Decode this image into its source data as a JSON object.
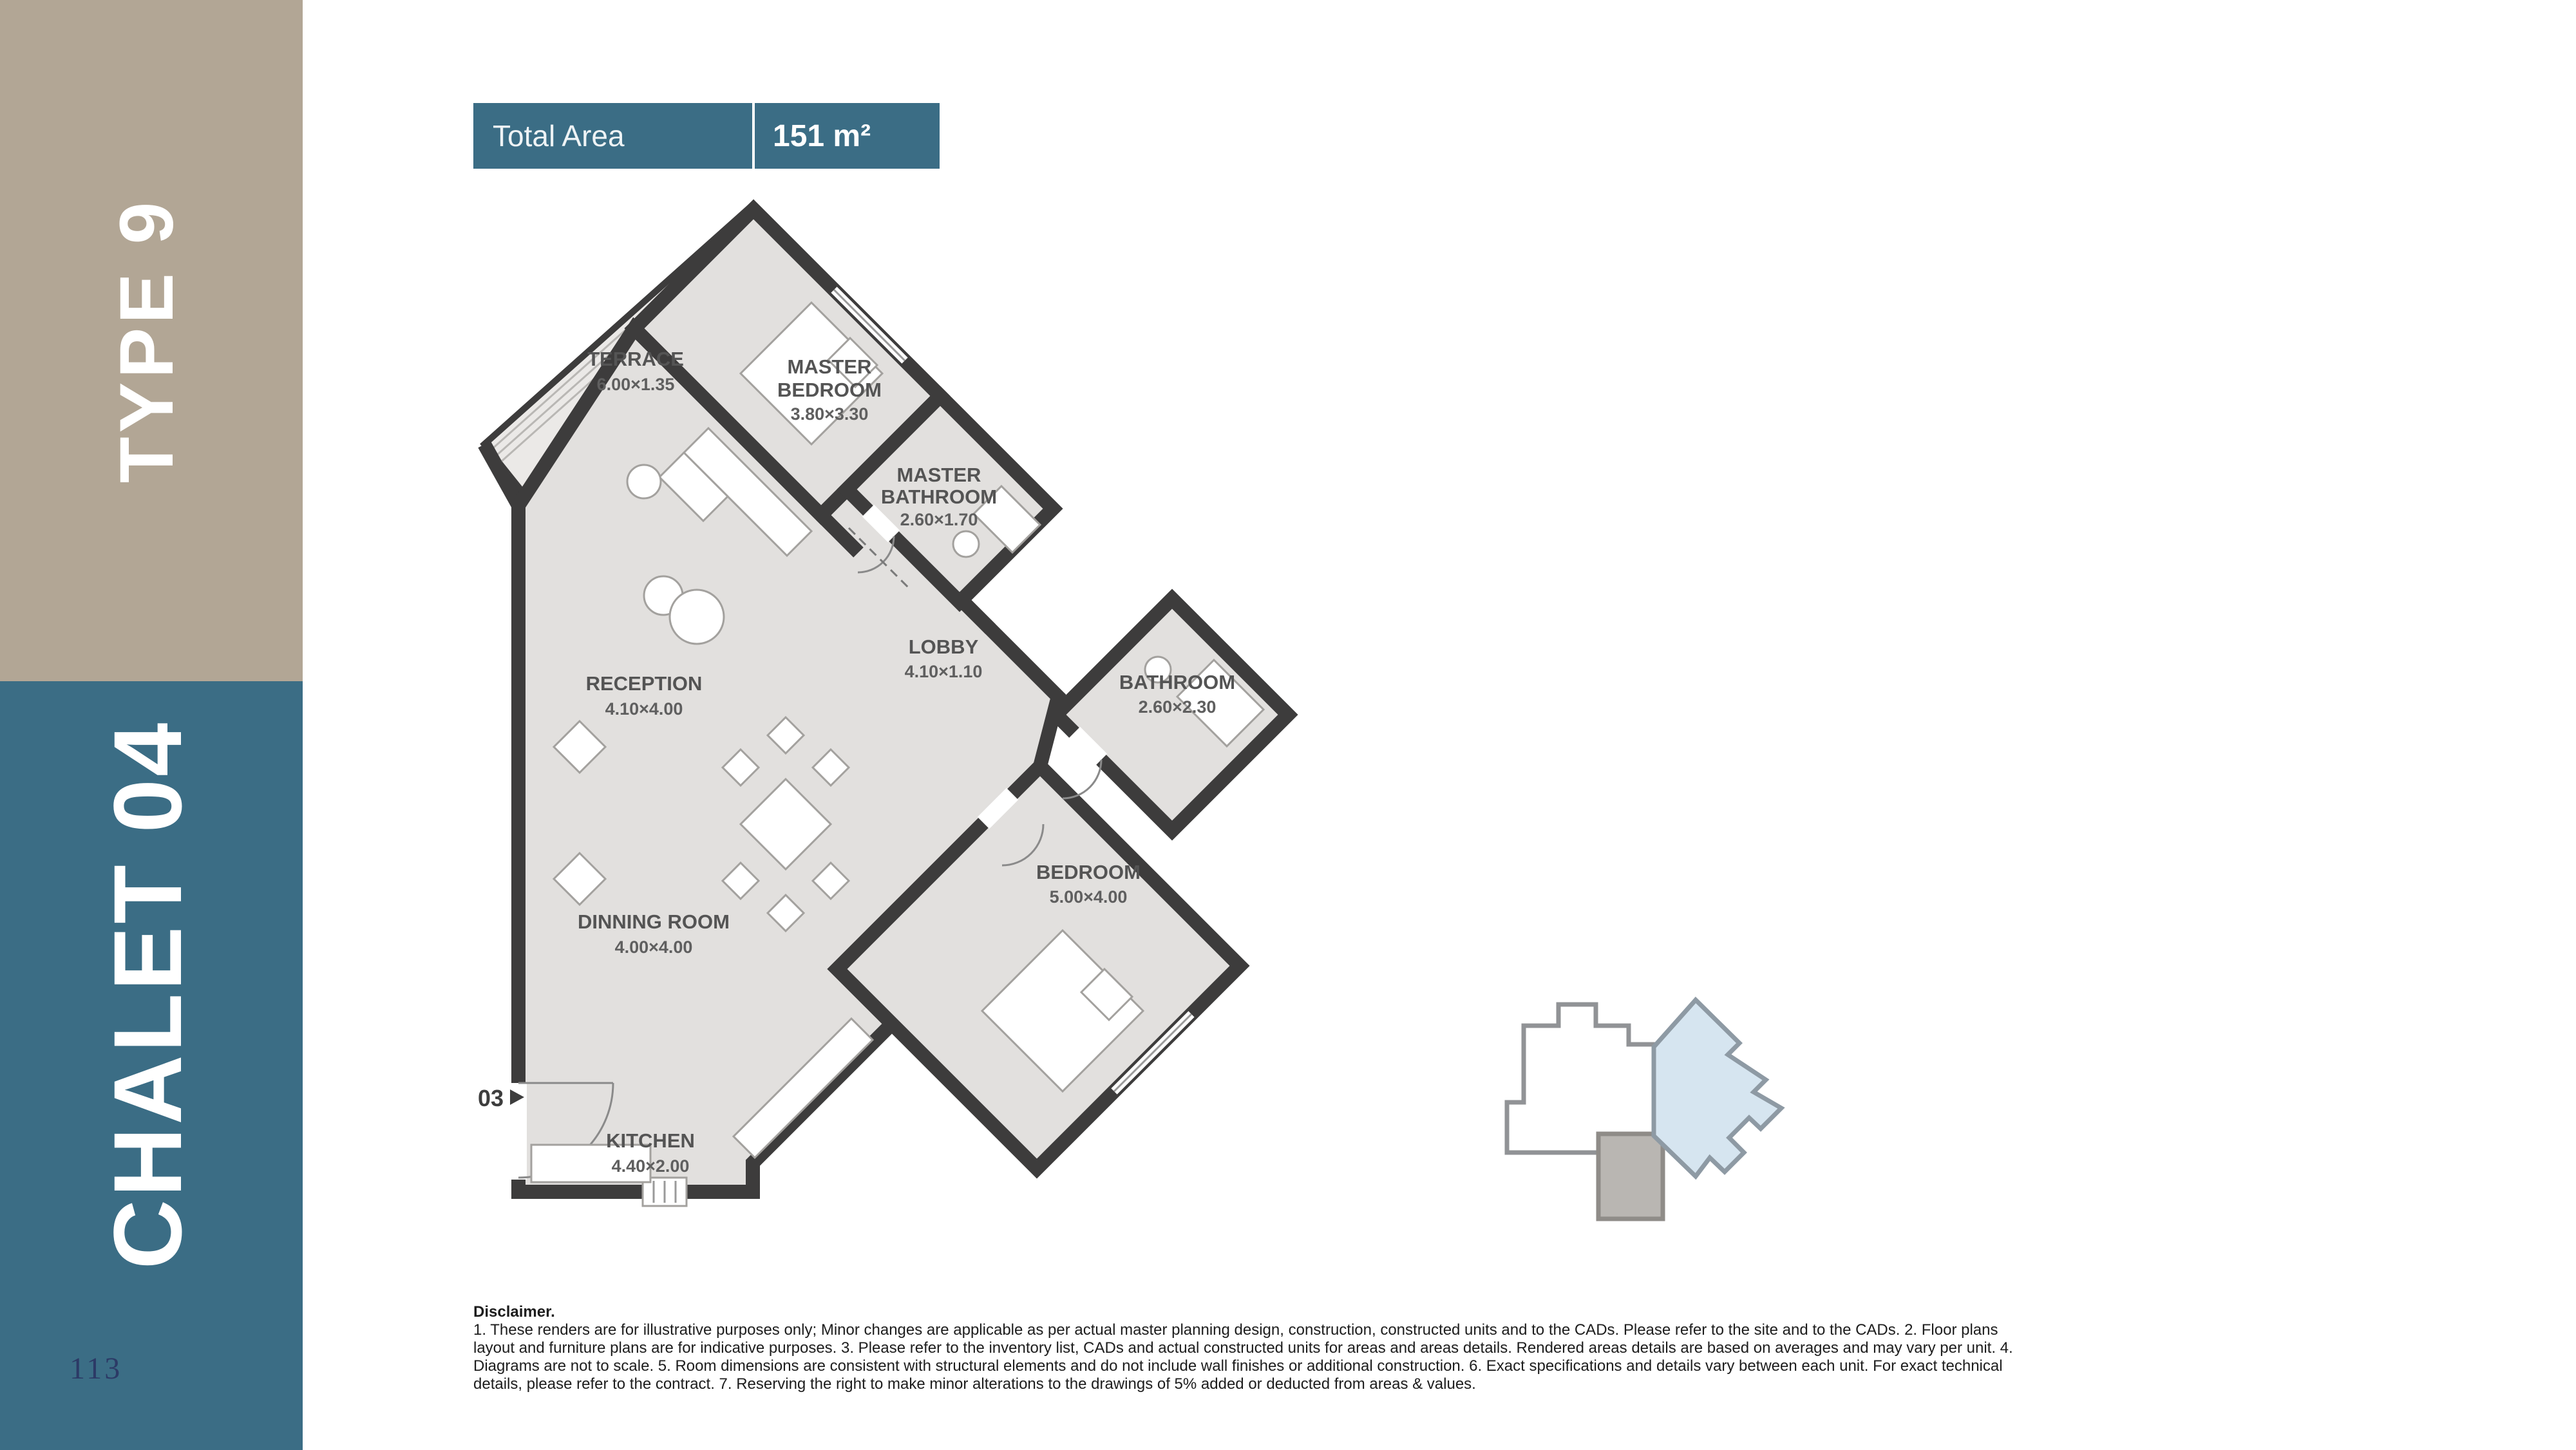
{
  "theme": {
    "tan": "#b2a695",
    "teal": "#3b6d85",
    "page_num_navy": "#2c3a66",
    "wall": "#3d3c3c",
    "floor": "#e2e0de",
    "locator_blue": "#d6e5f0",
    "locator_gray": "#b9b6b2"
  },
  "sidebar": {
    "type_label": "TYPE 9",
    "chalet_label": "CHALET 04",
    "page_number": "113"
  },
  "header": {
    "total_area_label": "Total Area",
    "total_area_value": "151 m²"
  },
  "floor_plan": {
    "entrance_label": "03",
    "rooms": [
      {
        "line1": "TERRACE",
        "line2": "",
        "dims": "6.00×1.35"
      },
      {
        "line1": "MASTER",
        "line2": "BEDROOM",
        "dims": "3.80×3.30"
      },
      {
        "line1": "MASTER",
        "line2": "BATHROOM",
        "dims": "2.60×1.70"
      },
      {
        "line1": "RECEPTION",
        "line2": "",
        "dims": "4.10×4.00"
      },
      {
        "line1": "LOBBY",
        "line2": "",
        "dims": "4.10×1.10"
      },
      {
        "line1": "BATHROOM",
        "line2": "",
        "dims": "2.60×2.30"
      },
      {
        "line1": "DINNING ROOM",
        "line2": "",
        "dims": "4.00×4.00"
      },
      {
        "line1": "BEDROOM",
        "line2": "",
        "dims": "5.00×4.00"
      },
      {
        "line1": "KITCHEN",
        "line2": "",
        "dims": "4.40×2.00"
      }
    ]
  },
  "disclaimer": {
    "title": "Disclaimer.",
    "lines": [
      "1. These renders are for illustrative purposes only; Minor changes are applicable as per actual master planning design, construction, constructed units and to the CADs. Please refer to the site and to the CADs. 2. Floor plans",
      "layout and furniture plans are for indicative purposes. 3. Please refer to the inventory list, CADs and actual constructed units for areas and areas details. Rendered areas details are based on averages and may vary per unit. 4.",
      "Diagrams are not to scale. 5. Room dimensions are consistent with structural elements and do not include wall finishes or additional construction. 6. Exact specifications and details vary between each unit. For exact technical",
      "details, please refer to the contract. 7. Reserving the right to make minor alterations to the drawings of 5% added or deducted from areas & values."
    ]
  }
}
